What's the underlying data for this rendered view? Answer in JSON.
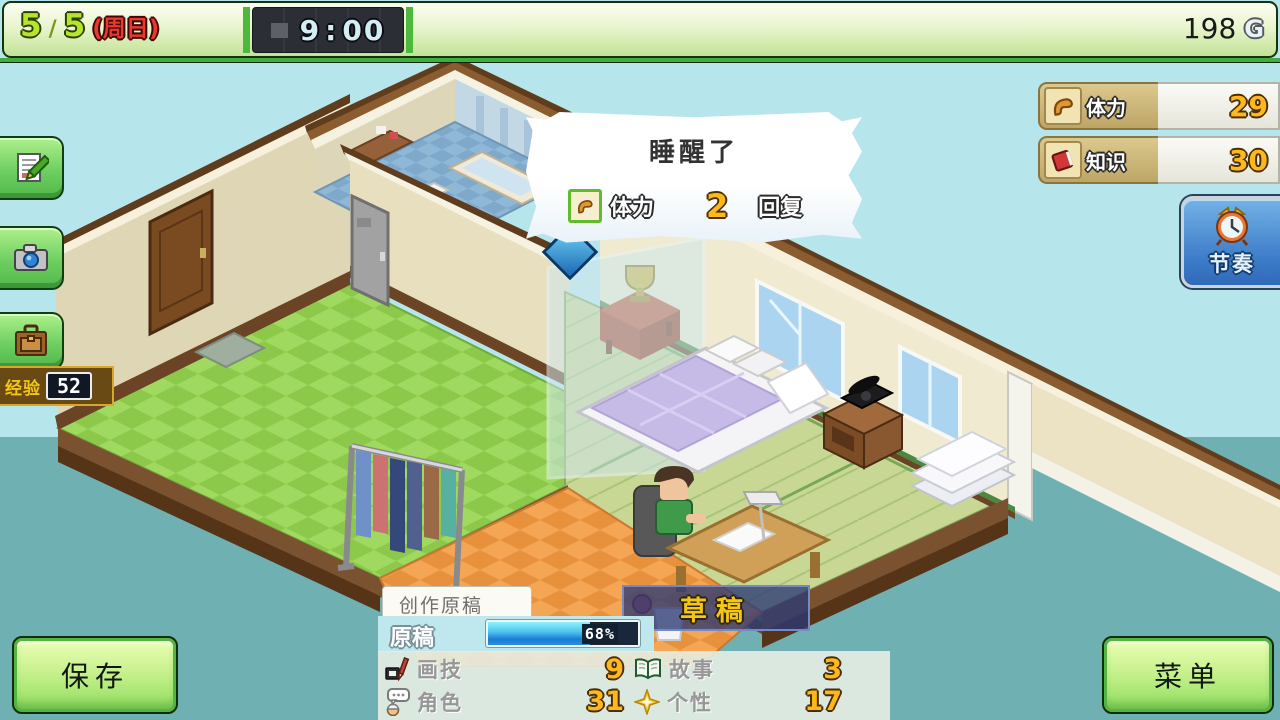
{
  "top_bar": {
    "day_current": "5",
    "day_sep": "/",
    "day_total": "5",
    "weekday": "(周日)",
    "time_hour": "9",
    "time_colon": ":",
    "time_min": "00",
    "money": "198",
    "currency": "G"
  },
  "left_toolbar": {
    "exp_label": "经验",
    "exp_value": "52"
  },
  "stats_panel": {
    "stamina_label": "体力",
    "stamina_value": "29",
    "knowledge_label": "知识",
    "knowledge_value": "30"
  },
  "pace_button": {
    "label": "节奏"
  },
  "speech_bubble": {
    "title": "睡醒了",
    "stat_label": "体力",
    "stat_value": "2",
    "suffix": "回复"
  },
  "action_label": {
    "text": "草稿"
  },
  "work_panel": {
    "tab": "创作原稿",
    "progress_label": "原稿",
    "progress_percent": 68,
    "progress_text": "68%",
    "stats": [
      {
        "label": "画技",
        "value": "9"
      },
      {
        "label": "故事",
        "value": "3"
      },
      {
        "label": "角色",
        "value": "31"
      },
      {
        "label": "个性",
        "value": "17"
      }
    ]
  },
  "buttons": {
    "save": "保存",
    "menu": "菜单"
  },
  "colors": {
    "accent_green": "#50b848",
    "gold": "#ffb81c",
    "hud_blue": "#3d7cc8",
    "sky": "#b7e5ec",
    "teal": "#6fb1b3"
  }
}
